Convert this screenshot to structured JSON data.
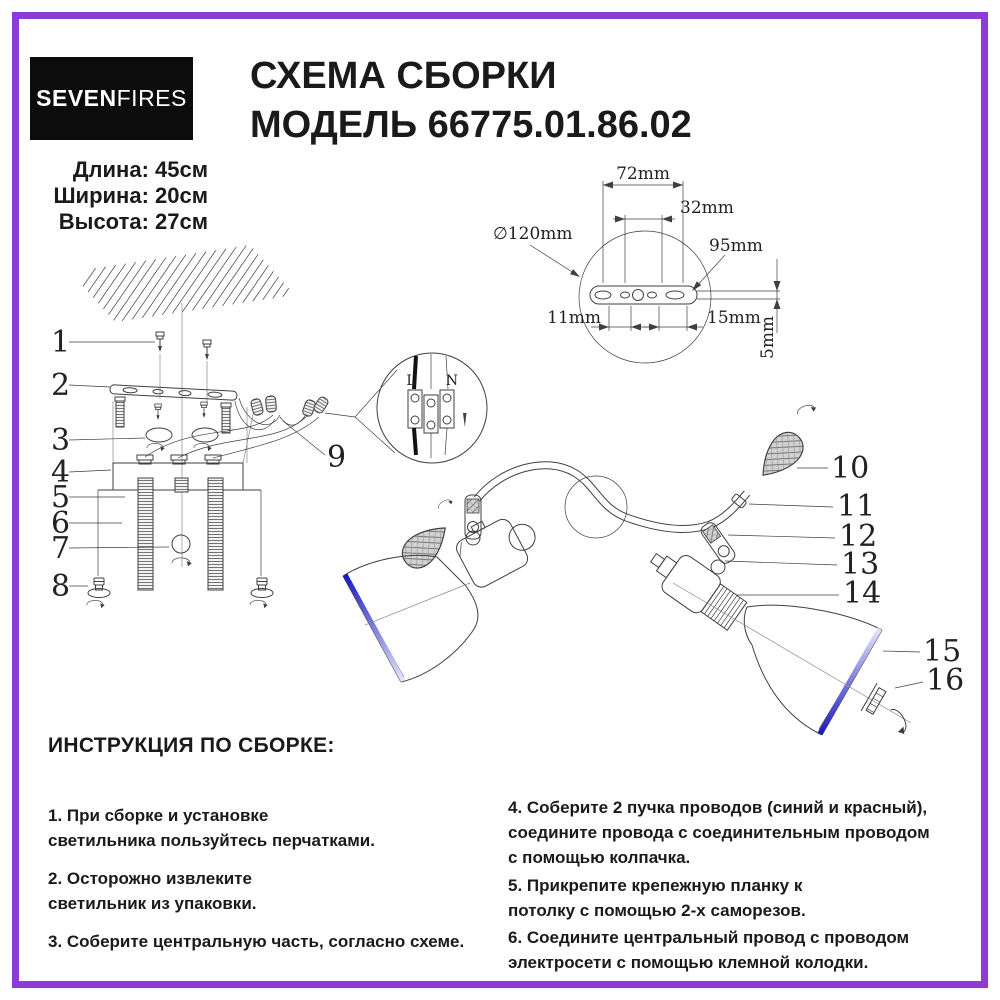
{
  "theme": {
    "purple": "#8d3bd8",
    "ink": "#1a1a1a",
    "line": "#3f3f3f",
    "blue_dark": "#1919bc",
    "blue_light": "#e2e5fb",
    "logo_bg": "#0c0c0c"
  },
  "header": {
    "logo": {
      "part1": "SEVEN",
      "part2": "FIRES"
    },
    "title": "СХЕМА СБОРКИ\nМОДЕЛЬ 66775.01.86.02"
  },
  "specs": {
    "length": "Длина: 45см",
    "width": "Ширина: 20см",
    "height": "Высота: 27см"
  },
  "diagram": {
    "callouts": {
      "c1": "1",
      "c2": "2",
      "c3": "3",
      "c4": "4",
      "c5": "5",
      "c6": "6",
      "c7": "7",
      "c8": "8",
      "c9": "9",
      "c10": "10",
      "c11": "11",
      "c12": "12",
      "c13": "13",
      "c14": "14",
      "c15": "15",
      "c16": "16"
    },
    "detail": {
      "l": "L",
      "n": "N"
    },
    "dims": {
      "d72": "72mm",
      "d32": "32mm",
      "d95": "95mm",
      "d120": "∅120mm",
      "d11": "11mm",
      "d15": "15mm",
      "d5": "5mm"
    }
  },
  "instructions": {
    "heading": "ИНСТРУКЦИЯ ПО СБОРКЕ:",
    "left": [
      "1. При сборке и установке\nсветильника пользуйтесь перчатками.",
      "2. Осторожно извлеките\nсветильник из упаковки.",
      "3. Соберите центральную часть, согласно схеме."
    ],
    "right": [
      "4. Соберите 2 пучка проводов (синий и красный),\nсоедините провода с соединительным проводом\nс помощью колпачка.",
      "5. Прикрепите крепежную планку к\nпотолку с помощью 2-х саморезов.",
      "6. Соедините центральный провод с проводом\nэлектросети с помощью клемной колодки."
    ]
  }
}
